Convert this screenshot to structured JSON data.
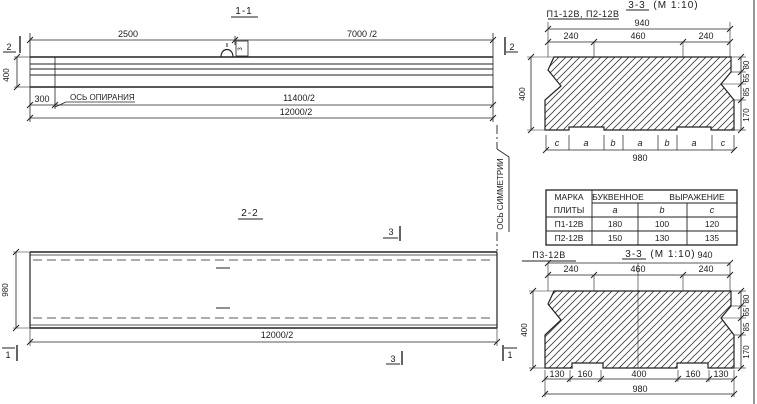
{
  "section_1_1": {
    "title": "1-1",
    "cut_label_left": "2",
    "cut_label_right": "2",
    "dim_2500": "2500",
    "dim_7000": "7000 /2",
    "dim_400": "400",
    "dim_300": "300",
    "support_axis_label": "ОСЬ ОПИРАНИЯ",
    "dim_11400": "11400/2",
    "dim_12000": "12000/2",
    "loop_tag": "3"
  },
  "section_2_2": {
    "title": "2-2",
    "cut_label_3_top": "3",
    "cut_label_3_bottom": "3",
    "cut_label_1_left": "1",
    "cut_label_1_right": "1",
    "dim_980": "980",
    "dim_12000": "12000/2",
    "symmetry_axis_label": "ОСЬ СИММЕТРИИ"
  },
  "section_top_right": {
    "marks_label": "П1-12В, П2-12В",
    "title": "3-3",
    "scale": "(М 1:10)",
    "dim_940": "940",
    "dim_240_left": "240",
    "dim_460": "460",
    "dim_240_right": "240",
    "dim_400": "400",
    "dim_80": "80",
    "dim_65": "65",
    "dim_85": "85",
    "dim_170": "170",
    "letters": [
      "c",
      "a",
      "b",
      "a",
      "b",
      "a",
      "c"
    ],
    "dim_980": "980"
  },
  "table": {
    "header_col1_line1": "МАРКА",
    "header_col1_line2": "ПЛИТЫ",
    "header_word1": "БУКВЕННОЕ",
    "header_word2": "ВЫРАЖЕНИЕ",
    "col_a": "a",
    "col_b": "b",
    "col_c": "c",
    "rows": [
      {
        "mark": "П1-12В",
        "a": "180",
        "b": "100",
        "c": "120"
      },
      {
        "mark": "П2-12В",
        "a": "150",
        "b": "130",
        "c": "135"
      }
    ]
  },
  "section_bottom_right": {
    "mark_label": "П3-12В",
    "title": "3-3",
    "scale": "(М 1:10)",
    "dim_940": "940",
    "dim_240_left": "240",
    "dim_460": "460",
    "dim_240_right": "240",
    "dim_400": "400",
    "dim_80": "80",
    "dim_65": "65",
    "dim_85": "85",
    "dim_170": "170",
    "dims_bottom": [
      "130",
      "160",
      "400",
      "160",
      "130"
    ],
    "dim_980": "980"
  }
}
